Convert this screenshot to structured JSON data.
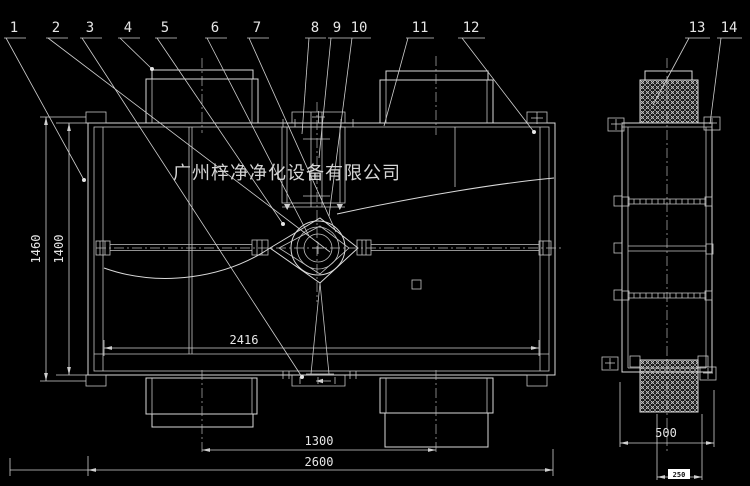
{
  "watermark": "广州梓净净化设备有限公司",
  "labels": [
    "1",
    "2",
    "3",
    "4",
    "5",
    "6",
    "7",
    "8",
    "9",
    "10",
    "11",
    "12",
    "13",
    "14"
  ],
  "dims": {
    "height_outer": "1460",
    "height_inner": "1400",
    "width_inner": "2416",
    "duct_spacing": "1300",
    "width_overall": "2600",
    "side_width": "500",
    "side_duct_width": "250"
  },
  "colors": {
    "background": "#000000",
    "line": "#d9d9d9",
    "text": "#e6e6e6",
    "highlight_bg": "#ffffff",
    "highlight_text": "#111111"
  }
}
